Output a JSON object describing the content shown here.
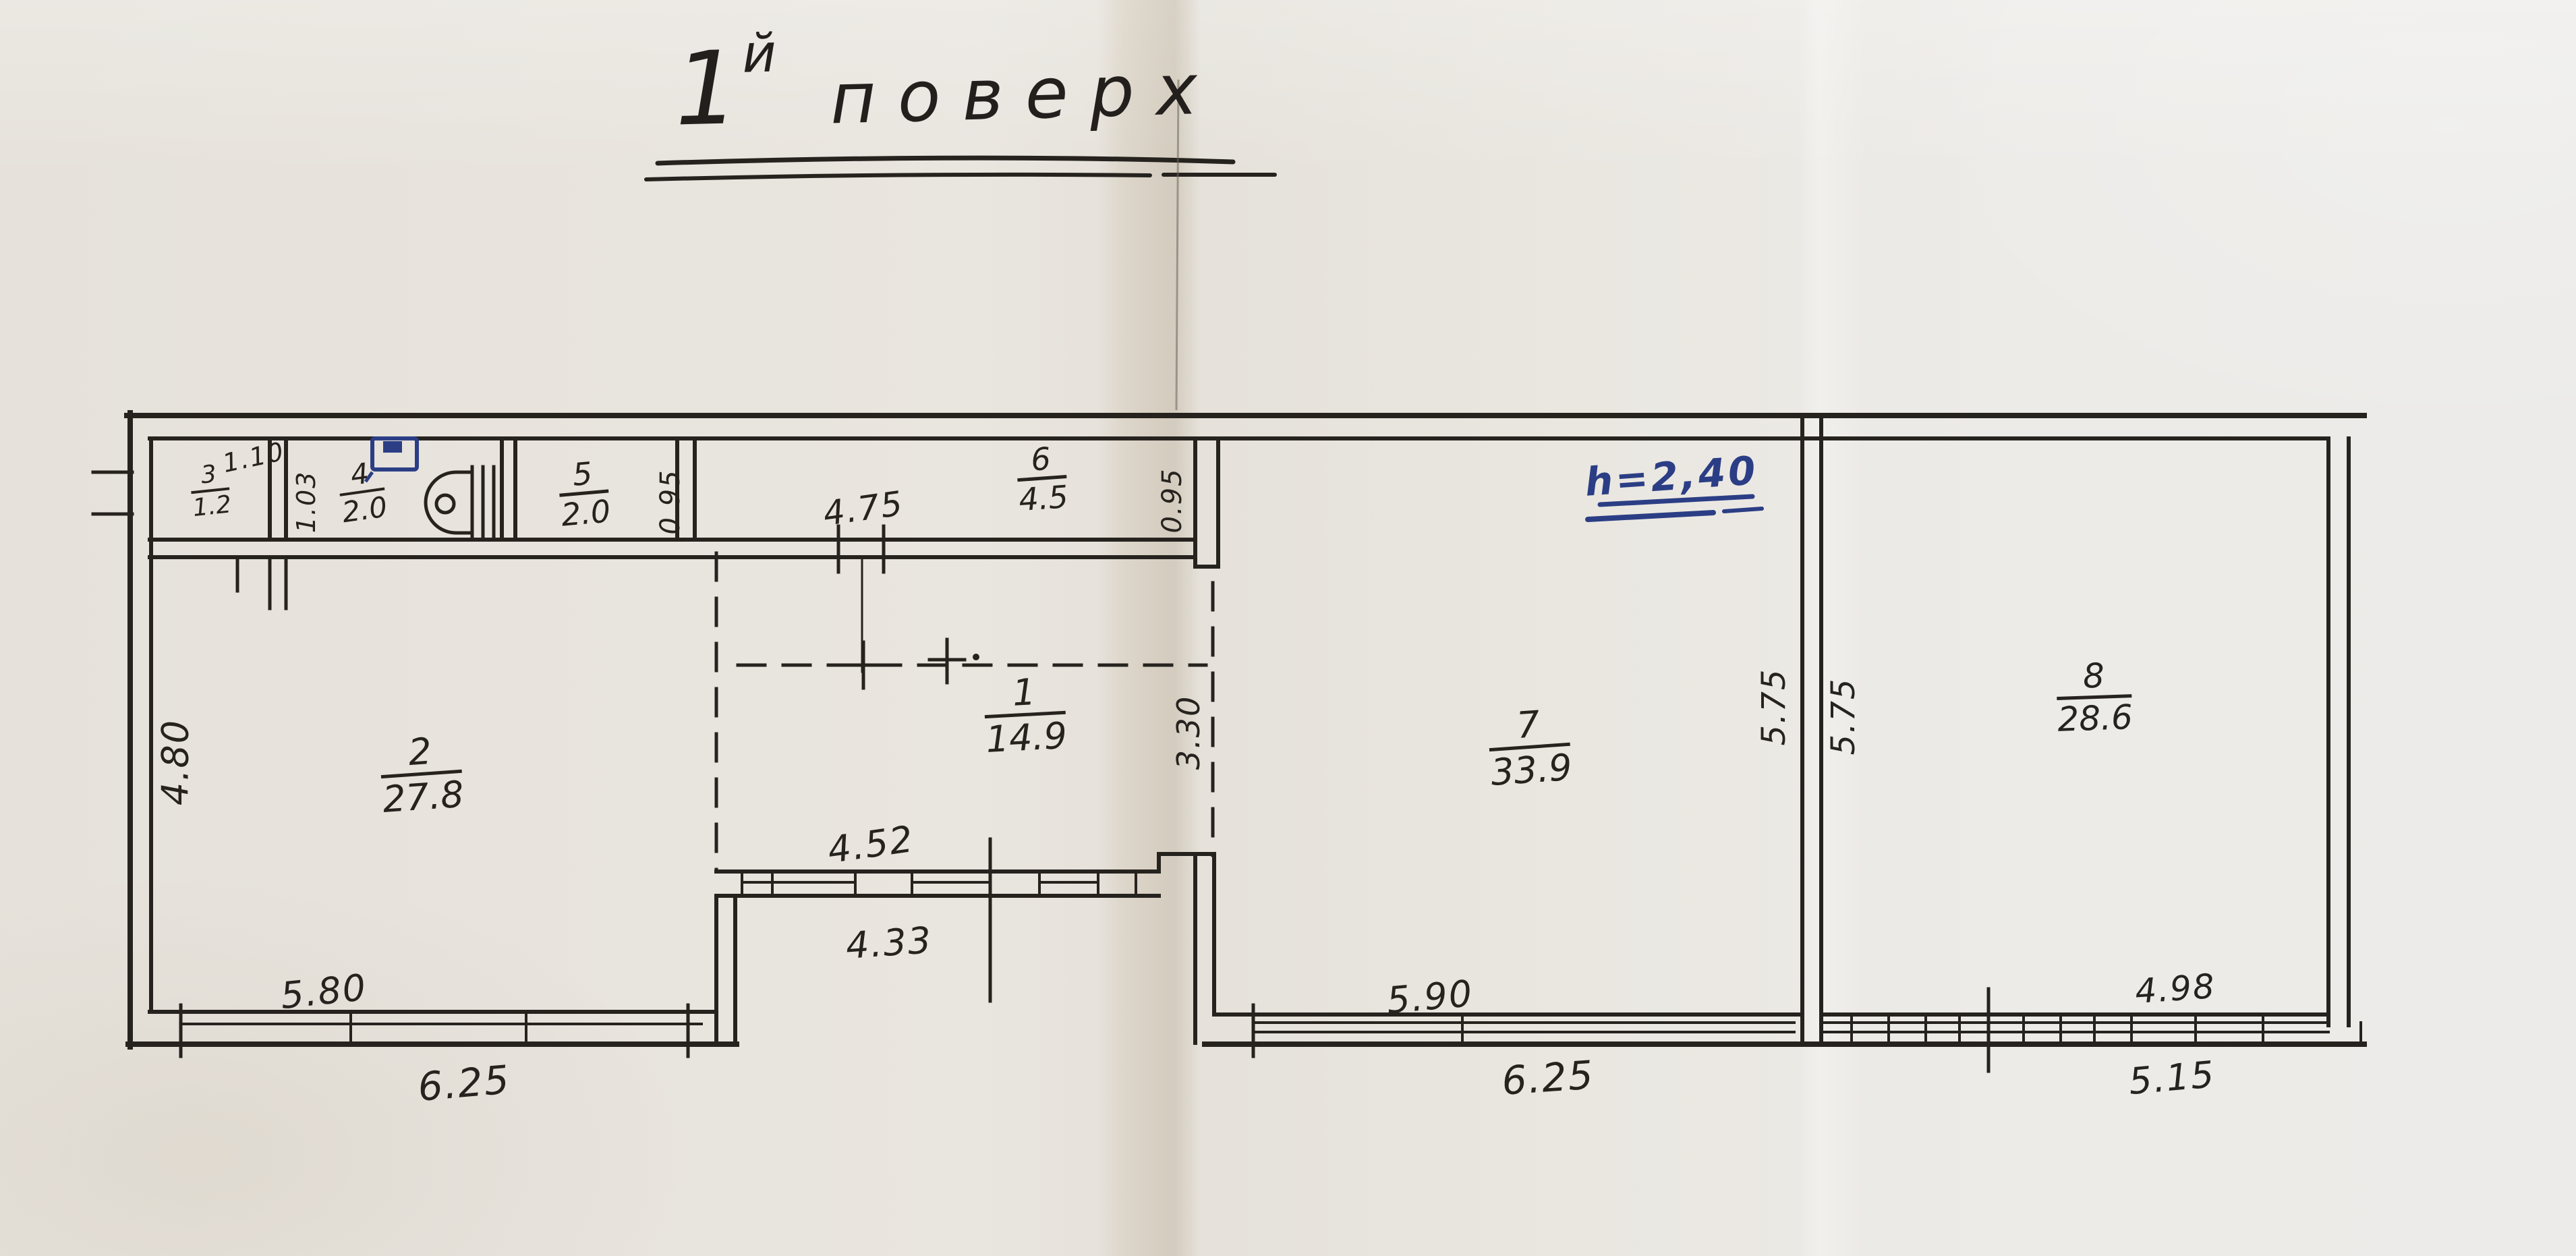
{
  "title": {
    "number": "1",
    "suffix": "й",
    "word": "поверх"
  },
  "annotations": {
    "ceiling_height": "h=2,40"
  },
  "rooms": [
    {
      "number": "1",
      "area": "14.9"
    },
    {
      "number": "2",
      "area": "27.8"
    },
    {
      "number": "3",
      "area": "1.2"
    },
    {
      "number": "4",
      "area": "2.0"
    },
    {
      "number": "5",
      "area": "2.0"
    },
    {
      "number": "6",
      "area": "4.5"
    },
    {
      "number": "7",
      "area": "33.9"
    },
    {
      "number": "8",
      "area": "28.6"
    }
  ],
  "dimensions": {
    "room3_width": "1.10",
    "hall_depth": "1.03",
    "room5_depth": "0.95",
    "room6_depth": "0.95",
    "corridor_width": "4.75",
    "room2_depth": "4.80",
    "opening_width": "3.30",
    "room1_window_inner": "4.52",
    "room1_window_outer": "4.33",
    "room2_bottom_inner": "5.80",
    "room2_bottom_outer": "6.25",
    "room7_bottom_inner": "5.90",
    "room7_bottom_outer": "6.25",
    "wall_7_8_left": "5.75",
    "wall_7_8_right": "5.75",
    "room8_bottom_inner": "4.98",
    "room8_bottom_outer": "5.15"
  },
  "icons": {
    "toilet": "toilet-plan-symbol",
    "sink": "sink-plan-symbol"
  },
  "colors": {
    "ink": "#26231f",
    "blue_ink": "#2b3e85",
    "paper": "#e8e5e0"
  }
}
